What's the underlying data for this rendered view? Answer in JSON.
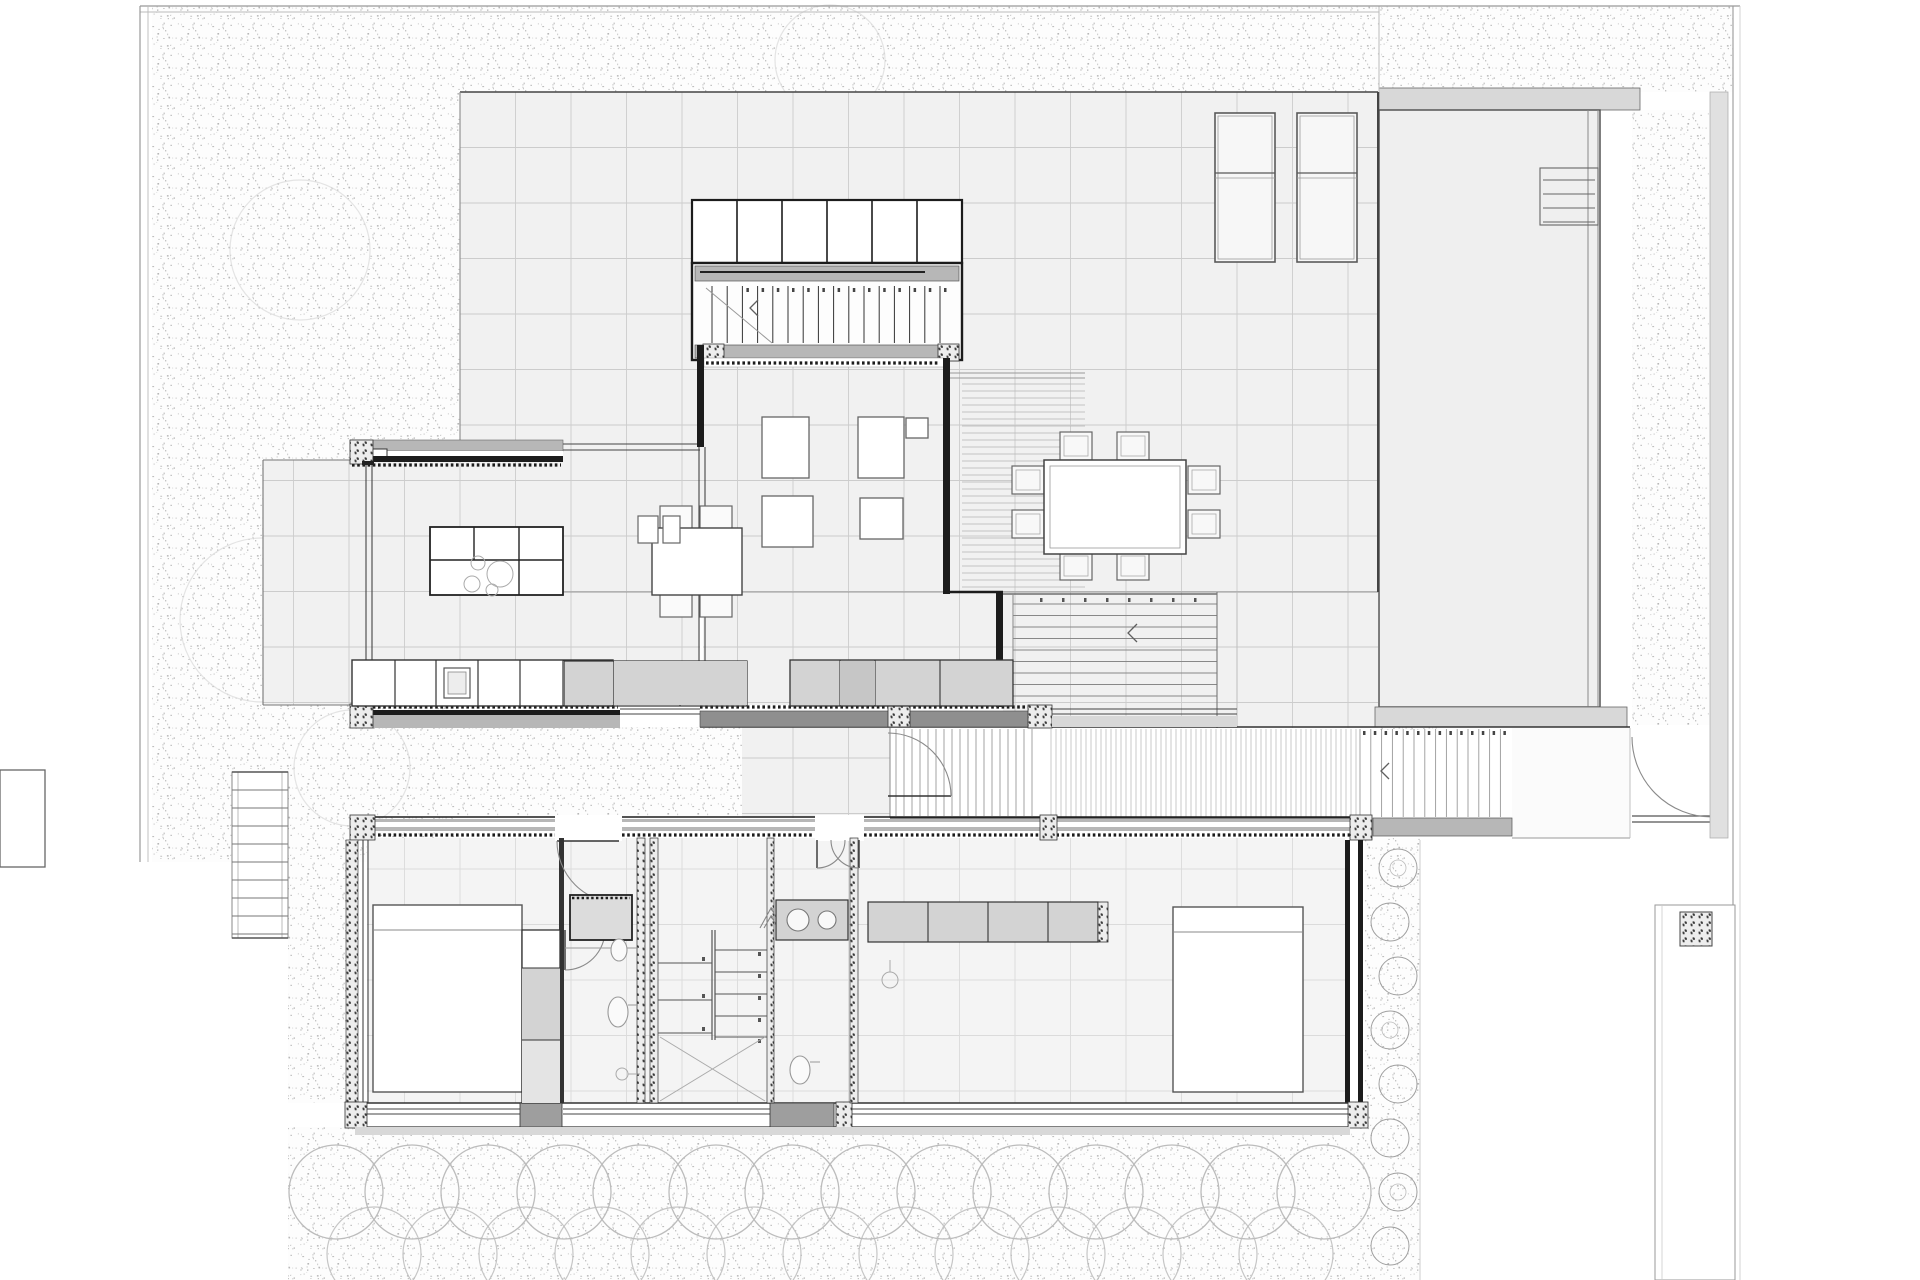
{
  "meta": {
    "title": "Architectural floor plan - villa ground floor with pool terrace",
    "drawing_type": "technical line drawing, no visible text labels"
  },
  "palette": {
    "paper": "#ffffff",
    "floor": "#f1f1f1",
    "floor_soft": "#f4f4f4",
    "grid_line": "#cccccc",
    "grid_line_soft": "#dbdbdb",
    "wall": "#1c1c1c",
    "wall_mid": "#555555",
    "clad_gray": "#b7b7b7",
    "band_gray": "#d8d8d8",
    "dark_band": "#8f8f8f",
    "cabinet": "#d3d3d3",
    "cabinet_dark": "#c6c6c6",
    "fixture": "#999999",
    "slat": "#a0a0a0",
    "stipple_dot": "#8f8f8f",
    "hedge": "#bcbcbc",
    "shrub": "#9f9f9f",
    "pool_fill": "#efefef",
    "boundary": "#999999",
    "tree": "#d9d9d9"
  },
  "plan": {
    "rooms": [
      {
        "id": "terrace",
        "label": "Gridded terrace"
      },
      {
        "id": "stair-pavilion",
        "label": "Wardrobe + stair block"
      },
      {
        "id": "kitchen-dining",
        "label": "Kitchen and dining wing"
      },
      {
        "id": "living-room",
        "label": "Living room volume"
      },
      {
        "id": "pool",
        "label": "Swimming pool"
      },
      {
        "id": "boardwalk",
        "label": "Timber boardwalk / entry path"
      },
      {
        "id": "bedroom-west",
        "label": "West bedroom"
      },
      {
        "id": "bathroom-west",
        "label": "West bathroom"
      },
      {
        "id": "stair-hall",
        "label": "Central stair hall"
      },
      {
        "id": "bathroom-east",
        "label": "East bathroom"
      },
      {
        "id": "bedroom-east",
        "label": "East bedroom"
      },
      {
        "id": "garden",
        "label": "Gravel garden"
      },
      {
        "id": "hedge",
        "label": "Scalloped hedge row"
      }
    ],
    "furniture": [
      "kitchen-island-with-hob",
      "dining-table-4-chairs",
      "kitchen-counter-row",
      "sink-cabinet",
      "sofa-group",
      "outdoor-dining-table-8-chairs",
      "sun-lounger",
      "sun-lounger",
      "double-bed-west",
      "double-bed-east",
      "wardrobe-column",
      "closet-row",
      "vanity-2-sinks",
      "toilet",
      "shower-tray",
      "pool-ladder"
    ],
    "counts": {
      "sun_loungers": 2,
      "pavilion_closet_cells": 6,
      "pavilion_stair_treads": 16,
      "exterior_stair_treads": 9,
      "hall_stair_treads_left": 3,
      "hall_stair_treads_right": 5,
      "hedge_circles_row1": 14,
      "hedge_circles_row2": 13,
      "shrub_circles": 8,
      "west_ladder_rungs": 9
    },
    "params": {
      "grid_origin_x": 460,
      "grid_origin_y": 92,
      "grid_spacing": 55.5,
      "deck_slat_spacing": 7,
      "boardwalk_fine_slat_spacing": 5,
      "boardwalk_step_spacing": 8,
      "boardwalk_wide_slat_spacing": 10.8,
      "ext_stair_tread_spacing": 11.5,
      "hedge_radius": 47,
      "hedge_row1_y": 1192,
      "hedge_row2_y": 1254,
      "hedge_start_x": 336,
      "hedge_step_x": 76
    }
  }
}
